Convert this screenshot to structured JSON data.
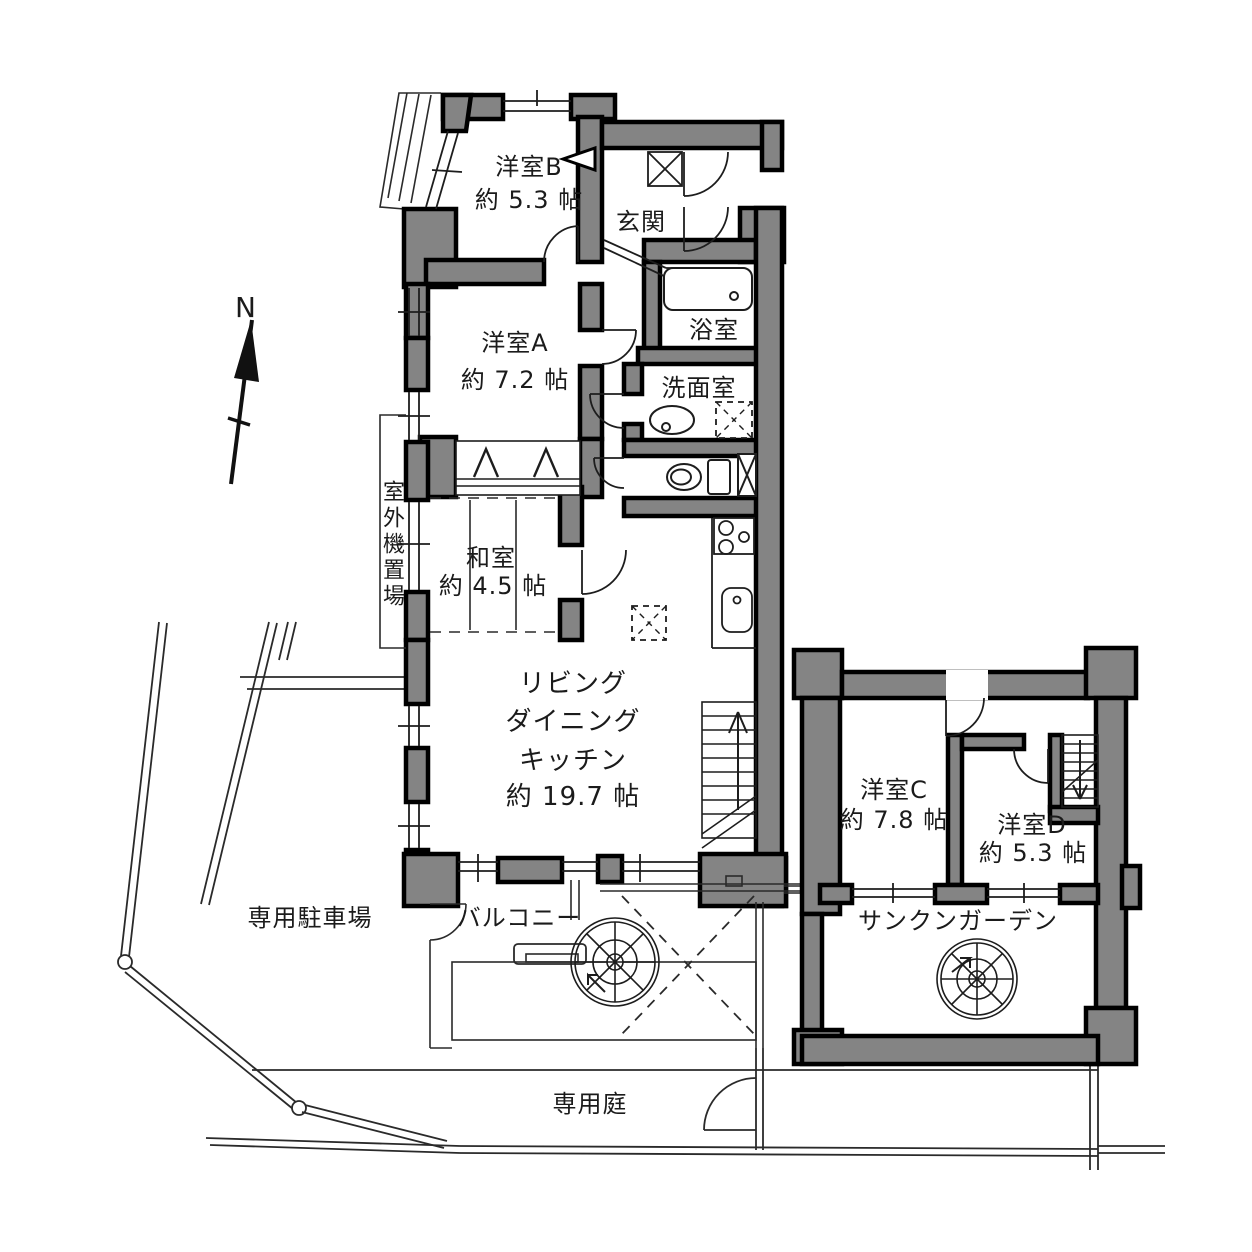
{
  "compass": {
    "north_label": "N"
  },
  "rooms": {
    "yoshitsu_b": {
      "name": "洋室B",
      "size": "約 5.3 帖"
    },
    "genkan": {
      "name": "玄関"
    },
    "yoshitsu_a": {
      "name": "洋室A",
      "size": "約 7.2 帖"
    },
    "bathroom": {
      "name": "浴室"
    },
    "washroom": {
      "name": "洗面室"
    },
    "washitsu": {
      "name": "和室",
      "size": "約 4.5 帖"
    },
    "ldk": {
      "line1": "リビング",
      "line2": "ダイニング",
      "line3": "キッチン",
      "size": "約 19.7 帖"
    },
    "yoshitsu_c": {
      "name": "洋室C",
      "size": "約 7.8 帖"
    },
    "yoshitsu_d": {
      "name": "洋室D",
      "size": "約 5.3 帖"
    }
  },
  "outdoor": {
    "outdoor_unit_space": "室外機置場",
    "balcony": "バルコニー",
    "sunken_garden": "サンクンガーデン",
    "private_parking": "専用駐車場",
    "private_garden": "専用庭"
  },
  "colors": {
    "wall": "#848484",
    "outline": "#000000",
    "thin_line": "#2a2a2a",
    "background": "#ffffff"
  }
}
